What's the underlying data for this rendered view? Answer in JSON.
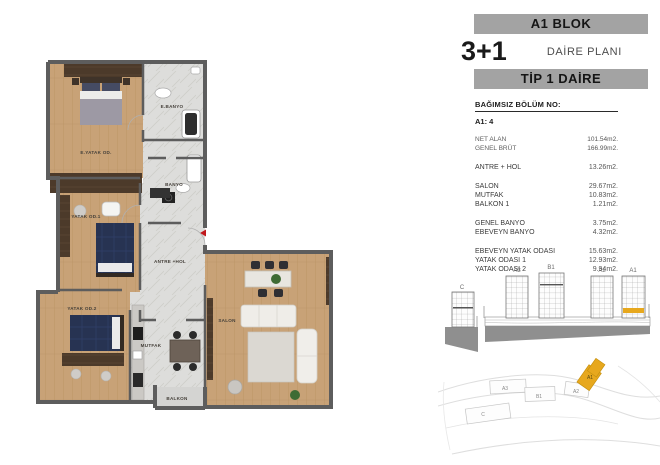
{
  "header": {
    "block_title": "A1 BLOK",
    "unit_config": "3+1",
    "plan_label": "DAİRE PLANI",
    "unit_type": "TİP 1 DAİRE"
  },
  "unit_info": {
    "section_no_label": "BAĞIMSIZ BÖLÜM NO:",
    "section_no_value": "A1: 4",
    "summary": [
      {
        "label": "NET ALAN",
        "value": "101.54m2."
      },
      {
        "label": "GENEL BRÜT",
        "value": "166.99m2."
      }
    ]
  },
  "room_areas": {
    "groups": [
      {
        "rows": [
          {
            "label": "ANTRE + HOL",
            "value": "13.26m2."
          }
        ]
      },
      {
        "rows": [
          {
            "label": "SALON",
            "value": "29.67m2."
          },
          {
            "label": "MUTFAK",
            "value": "10.83m2."
          },
          {
            "label": "BALKON 1",
            "value": "1.21m2."
          }
        ]
      },
      {
        "rows": [
          {
            "label": "GENEL BANYO",
            "value": "3.75m2."
          },
          {
            "label": "EBEVEYN BANYO",
            "value": "4.32m2."
          }
        ]
      },
      {
        "rows": [
          {
            "label": "EBEVEYN YATAK ODASI",
            "value": "15.63m2."
          },
          {
            "label": "YATAK ODASI 1",
            "value": "12.93m2."
          },
          {
            "label": "YATAK ODASI 2",
            "value": "9.94m2."
          }
        ]
      }
    ]
  },
  "floor_plan": {
    "rooms": [
      "E.YATAK OD.",
      "E.BANYO",
      "BANYO",
      "YATAK OD.1",
      "ANTRE +HOL",
      "YATAK OD.2",
      "MUTFAK",
      "SALON",
      "BALKON"
    ],
    "entrance_color": "#c0181c",
    "wall_color": "#5d5d5d",
    "wood_color": "#c8a277",
    "marble_color": "#dddddb"
  },
  "elevation": {
    "labels": [
      "C",
      "A3",
      "B1",
      "A2",
      "A1"
    ],
    "highlighted_building": "A1",
    "highlight_color": "#e7a81e"
  },
  "site_plan": {
    "labels": [
      "A3",
      "B1",
      "A2",
      "C",
      "A1"
    ],
    "highlighted_block": "A1",
    "highlight_color": "#e7a81e"
  }
}
